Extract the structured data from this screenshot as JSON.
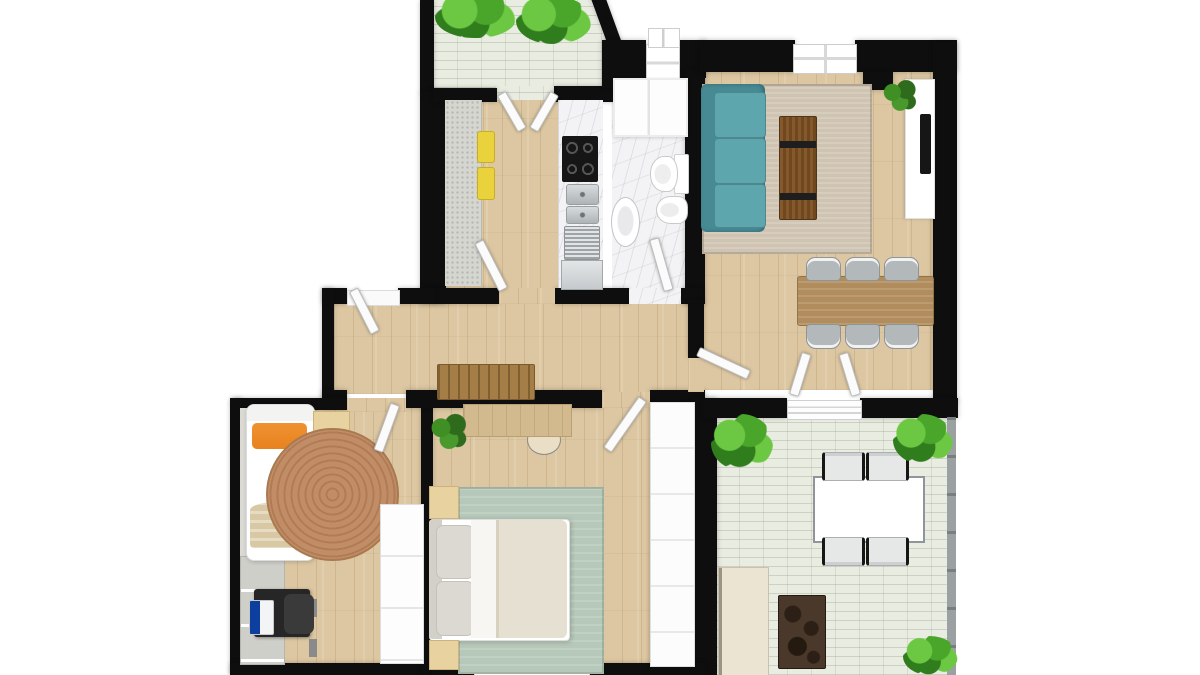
{
  "scene": {
    "type": "apartment-floor-plan-top-view",
    "canvas": {
      "width": 1200,
      "height": 675
    },
    "background": "#ffffff",
    "visible_text": "none"
  },
  "palette": {
    "wall": "#0e0e0e",
    "wood": "#ddc7a2",
    "tile": "#e9ece1",
    "marble": "#f3f2f4",
    "counter-gray": "#d6d6d0",
    "stool-yellow": "#e9d23b",
    "sofa-frame": "#478a94",
    "sofa-cushion": "#5da6ae",
    "rug-living": "#cfc3b2",
    "coffee-table": "#7a5328",
    "dining-wood": "#b18d5e",
    "chair-gray": "#b3b8bb",
    "bench-wood": "#a57d46",
    "jute": "#c18d67",
    "jute-ring": "#b17c55",
    "orange": "#e8821e",
    "blanket": "#d8c9a4",
    "desk-black": "#262626",
    "laptop-blue": "#0d3f9e",
    "sage": "#b6c8b9",
    "duvet": "#e6e0d2",
    "pillow-gray": "#dcd9d3",
    "beige": "#e8d2a0",
    "master-desk": "#d2ba8e",
    "dark-marble": "#4a382a",
    "cream": "#ece4d2",
    "railing": "#9ba0a2",
    "green-1": "#6cc843",
    "green-2": "#4aa62a",
    "green-3": "#2f7d1c",
    "door": "#fbfbfb",
    "steel": "#c3c7c9",
    "white": "#ffffff"
  },
  "rooms": [
    {
      "id": "balcony",
      "label": "balcony",
      "features": [
        "pale-tiled-floor",
        "two-overhanging-plants",
        "diagonal-outer-wall",
        "french-door-to-kitchen"
      ]
    },
    {
      "id": "kitchen",
      "label": "kitchen",
      "features": [
        "gray-counter-run",
        "two-yellow-stools",
        "black-cooktop-4-burners",
        "double-steel-sink",
        "steel-appliance",
        "dishwasher-front",
        "door-to-hallway"
      ]
    },
    {
      "id": "bathroom",
      "label": "bathroom",
      "features": [
        "white-marble-floor",
        "shower-enclosure",
        "toilet",
        "bidet",
        "oval-sink",
        "top-window",
        "door-to-hallway"
      ]
    },
    {
      "id": "living-room",
      "label": "living-dining-room",
      "features": [
        "teal-three-seat-sofa",
        "beige-area-rug",
        "rustic-plank-coffee-table",
        "white-tv-sideboard",
        "wall-tv",
        "corner-plant",
        "wood-dining-table",
        "six-gray-chairs",
        "top-window",
        "double-door-to-terrace",
        "opening-to-hallway"
      ]
    },
    {
      "id": "hallway",
      "label": "hallway",
      "features": [
        "wood-slat-bench",
        "entrance-door",
        "doors-to-all-rooms"
      ]
    },
    {
      "id": "kids-bedroom",
      "label": "kids-bedroom",
      "features": [
        "single-bed",
        "orange-pillow",
        "beige-blanket",
        "round-jute-rug",
        "black-desk",
        "dark-desk-chair",
        "laptop-blue-screen",
        "white-wardrobe",
        "gray-shelf-strip",
        "gray-low-cabinet",
        "beige-top-cabinet"
      ]
    },
    {
      "id": "master-bedroom",
      "label": "master-bedroom",
      "features": [
        "double-bed",
        "two-gray-pillows",
        "white-sheet-fold",
        "beige-duvet",
        "two-beige-nightstands",
        "sage-green-rug",
        "wood-desk",
        "round-stool",
        "corner-plant",
        "white-wardrobe",
        "bottom-window"
      ]
    },
    {
      "id": "terrace",
      "label": "terrace",
      "features": [
        "pale-brick-tile-floor",
        "white-outdoor-table",
        "four-black-frame-chairs",
        "dark-marble-side-table",
        "cream-tall-cabinet",
        "three-green-bushes",
        "right-side-railing"
      ]
    }
  ],
  "counts": {
    "dining_chairs_living": 6,
    "terrace_chairs": 4,
    "yellow_stools": 2,
    "bushes_terrace": 3,
    "balcony_plants": 2,
    "nightstands": 2,
    "door_leaves": 10
  }
}
